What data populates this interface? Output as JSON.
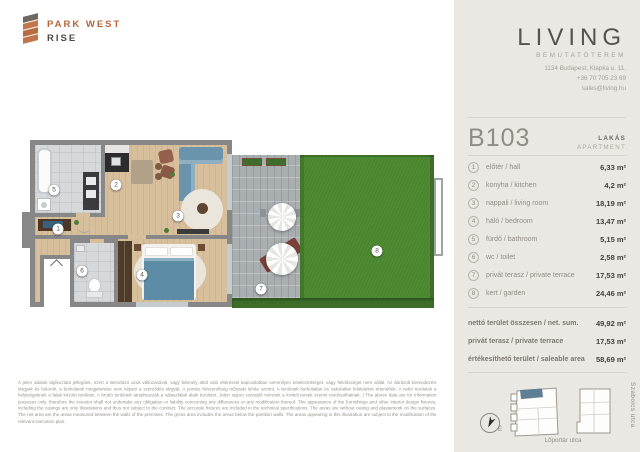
{
  "brand": {
    "name_line1": "PARK WEST",
    "name_line2": "RISE"
  },
  "showroom": {
    "name": "LIVING",
    "subtitle": "BEMUTATÓTEREM",
    "address": "1134 Budapest, Klapka u. 11.",
    "phone": "+36 70 705 23 69",
    "email": "sales@living.hu"
  },
  "unit": {
    "id": "B103",
    "type_hu": "LAKÁS",
    "type_en": "APARTMENT"
  },
  "rooms": [
    {
      "num": "1",
      "label": "előtér / hall",
      "area": "6,33 m²"
    },
    {
      "num": "2",
      "label": "konyha / kitchen",
      "area": "4,2 m²"
    },
    {
      "num": "3",
      "label": "nappali / living room",
      "area": "18,19 m²"
    },
    {
      "num": "4",
      "label": "háló / bedroom",
      "area": "13,47 m²"
    },
    {
      "num": "5",
      "label": "fürdő / bathroom",
      "area": "5,15 m²"
    },
    {
      "num": "6",
      "label": "wc / toilet",
      "area": "2,58 m²"
    },
    {
      "num": "7",
      "label": "privát terasz / private terrace",
      "area": "17,53 m²"
    },
    {
      "num": "8",
      "label": "kert / garden",
      "area": "24,46 m²"
    }
  ],
  "totals": [
    {
      "label": "nettó terület összesen / net. sum.",
      "value": "49,92 m²"
    },
    {
      "label": "privát terasz / private terrace",
      "value": "17,53 m²"
    },
    {
      "label": "értékesíthető terület / saleable area",
      "value": "58,69 m²"
    }
  ],
  "floor_plan": {
    "markers": [
      {
        "num": "1",
        "x": 28,
        "y": 91
      },
      {
        "num": "2",
        "x": 86,
        "y": 47
      },
      {
        "num": "3",
        "x": 148,
        "y": 78
      },
      {
        "num": "4",
        "x": 112,
        "y": 137
      },
      {
        "num": "5",
        "x": 24,
        "y": 52
      },
      {
        "num": "6",
        "x": 52,
        "y": 133
      },
      {
        "num": "7",
        "x": 231,
        "y": 151
      },
      {
        "num": "8",
        "x": 347,
        "y": 113
      }
    ]
  },
  "site_map": {
    "compass_label": "É",
    "street_bottom": "Lőportár utca",
    "street_right": "Szabolcs utca"
  },
  "disclaimer": "A jelen adatok tájékoztató jellegűek, ezért a Beruházó azok változásával, vagy bármely attól való eltéréssel kapcsolatban semmilyen kötelezettséget, vagy felelősséget nem vállal. Az ábrázolt berendezési tárgyak és bútorok, a burkolatok megjelenése nem képezi a szerződés tárgyát. A pontos felszereltség műszaki leírás szerint. A területek burkolatlan és vakolatlan felületekre értendőek. A nettó területek a helyiségeknek a falak közötti területei. A bruttó területek tartalmazzák a válaszfalak alatti területet. Jelen rajzon szereplő méretek a kiviteli tervek szerint módosulhatnak. | The above data are for information purposes only, therefore the investor shall not undertake any obligation or liability concerning any differences or any modification thereof. The appearance of the furnishings and other interior design fixtures, including the casings are only illustrations and thus not subject to the contract. The accurate fixtures are included in the technical specifications. The areas are without casing and plasterwork on the surfaces. The net area are the areas measured between the walls of the premises. The gross area includes the areas below the partition walls. The areas appearing in this illustration are subject to the modification of the relevant execution plan.",
  "colors": {
    "accent_copper": "#b96f44",
    "panel_bg": "#eae8e2",
    "highlight_slate": "#5d7f95",
    "grass_green": "#4e8b32",
    "wall_gray": "#878787"
  }
}
